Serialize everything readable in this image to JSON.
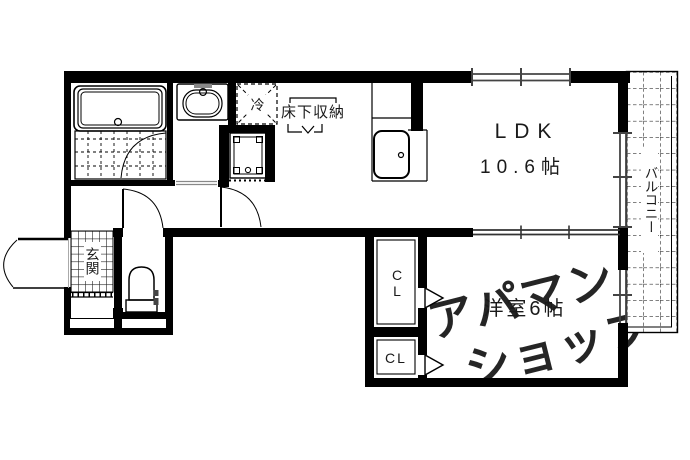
{
  "floor_plan": {
    "rooms": {
      "ldk": {
        "name": "LDK",
        "size": "10.6帖"
      },
      "bedroom": {
        "label": "洋室6帖"
      },
      "balcony": {
        "label": "バルコニー"
      },
      "entrance": {
        "label": "玄関"
      },
      "closet_upper": {
        "label": "CL"
      },
      "closet_lower": {
        "label": "CL"
      },
      "underfloor_storage": {
        "label": "床下収納"
      },
      "refrigerator": {
        "label": "冷"
      }
    },
    "watermark": {
      "line1": "アパマン",
      "line2": "ショップ",
      "color": "#c8c8c8"
    },
    "colors": {
      "wall": "#000000",
      "background": "#ffffff"
    }
  }
}
